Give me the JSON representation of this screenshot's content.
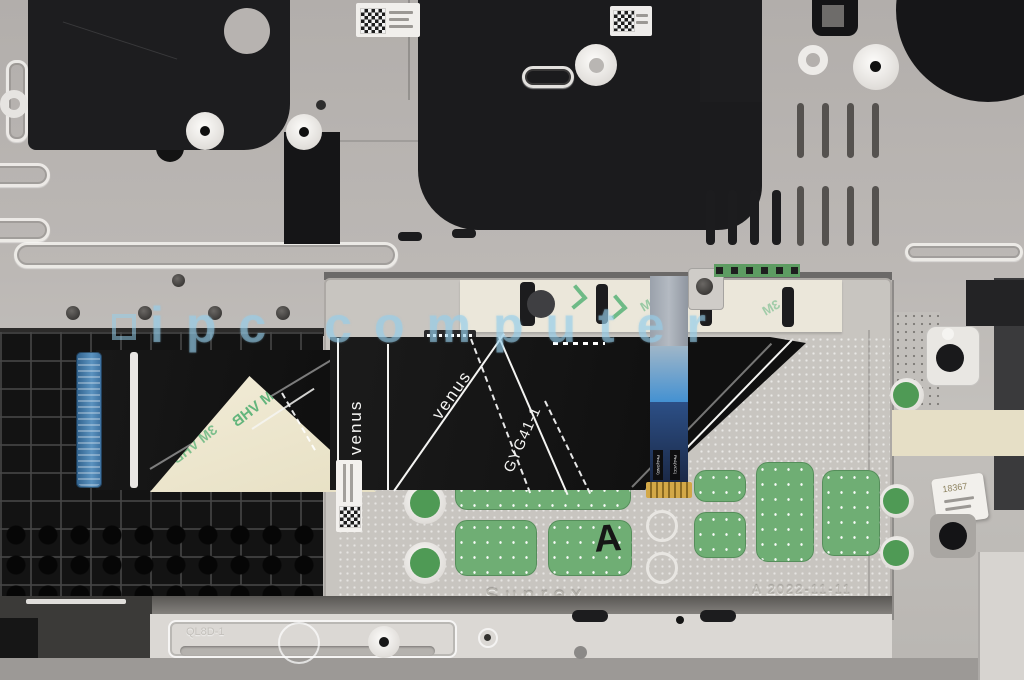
{
  "meta": {
    "type": "photograph",
    "subject": "Laptop palmrest internal view with touchpad module and ribbon cables"
  },
  "watermark": {
    "text": "ipc computer",
    "color": "#a5d2e8"
  },
  "ribbon": {
    "vertical_marking": "venus",
    "diagonal_marking": "venus",
    "part_marking": "GYG41-1"
  },
  "touchpad": {
    "brand": "Sunrex",
    "date_code": "A 2022-11-11",
    "grade": "A",
    "pin1_left": "Pin1(GND)",
    "pin1_right": "Pin1(VCC)"
  },
  "tape": {
    "mirrored_text": "3M VHB",
    "band_text": "3M"
  },
  "stickers": {
    "right_label": "18367"
  },
  "chassis": {
    "lip_marking": "QL8D-1"
  },
  "colors": {
    "metal": "#bcb8b5",
    "black_panel": "#1b1b1d",
    "cable_black": "#141414",
    "pcb_green": "#6fae74",
    "tape_cream": "#efe9d2",
    "tape_green_print": "#3aa763",
    "blue_cable": "#3e8fd0",
    "watermark_blue": "#a5d2e8"
  }
}
